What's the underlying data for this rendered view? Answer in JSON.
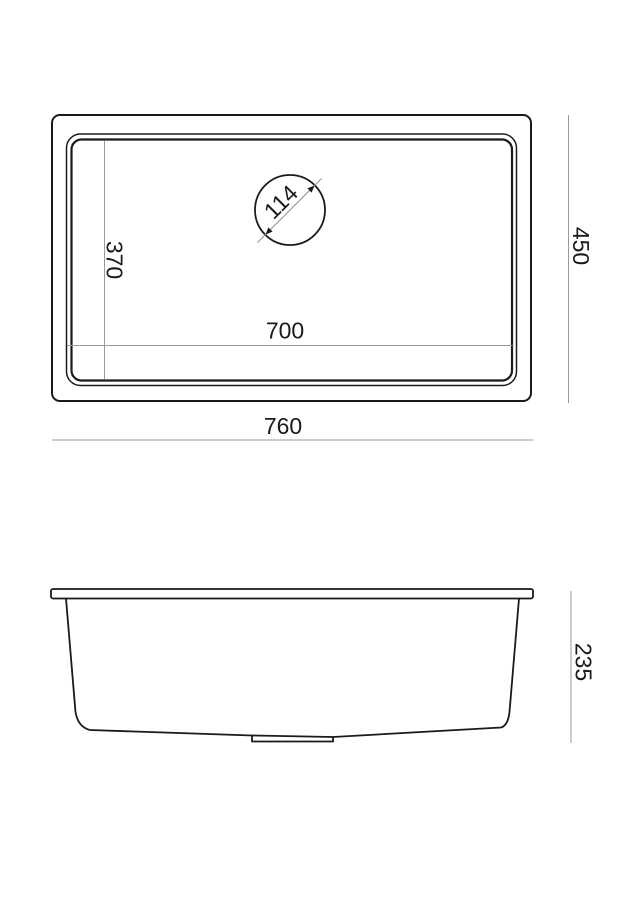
{
  "diagram": {
    "colors": {
      "background": "#ffffff",
      "object_line": "#1a1a1a",
      "dimension_line": "#9a9a9a",
      "text": "#1a1a1a"
    },
    "top_view": {
      "overall_width_label": "760",
      "overall_depth_label": "450",
      "bowl_width_label": "700",
      "bowl_depth_label": "370",
      "drain_diameter_label": "114"
    },
    "side_view": {
      "height_label": "235"
    }
  }
}
